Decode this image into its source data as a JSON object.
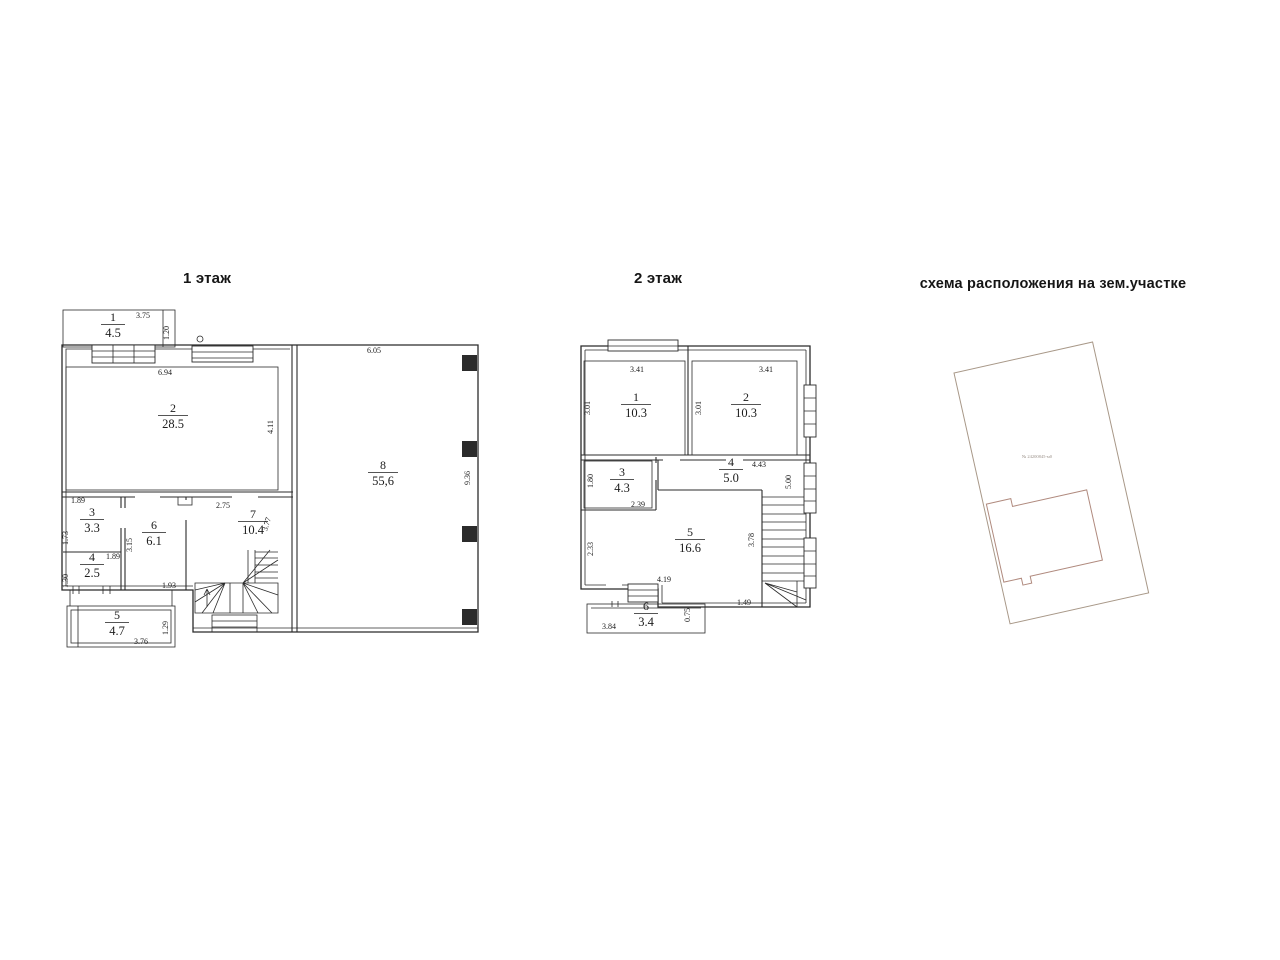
{
  "titles": {
    "floor1": "1 этаж",
    "floor2": "2 этаж",
    "site": "схема расположения на зем.участке"
  },
  "floor1": {
    "rooms": [
      {
        "n": "1",
        "a": "4.5",
        "x": 113,
        "y": 321
      },
      {
        "n": "2",
        "a": "28.5",
        "x": 173,
        "y": 412
      },
      {
        "n": "3",
        "a": "3.3",
        "x": 92,
        "y": 516
      },
      {
        "n": "4",
        "a": "2.5",
        "x": 92,
        "y": 561
      },
      {
        "n": "5",
        "a": "4.7",
        "x": 117,
        "y": 619
      },
      {
        "n": "6",
        "a": "6.1",
        "x": 154,
        "y": 529
      },
      {
        "n": "7",
        "a": "10.4",
        "x": 253,
        "y": 518
      },
      {
        "n": "8",
        "a": "55,6",
        "x": 383,
        "y": 469
      }
    ],
    "dims": [
      {
        "t": "3.75",
        "x": 143,
        "y": 318,
        "r": 0
      },
      {
        "t": "1.20",
        "x": 169,
        "y": 333,
        "r": -90
      },
      {
        "t": "6.94",
        "x": 165,
        "y": 375,
        "r": 0
      },
      {
        "t": "4.11",
        "x": 273,
        "y": 427,
        "r": -90
      },
      {
        "t": "1.89",
        "x": 78,
        "y": 503,
        "r": 0
      },
      {
        "t": "1.73",
        "x": 68,
        "y": 538,
        "r": -90
      },
      {
        "t": "1.89",
        "x": 113,
        "y": 559,
        "r": 0
      },
      {
        "t": "1.30",
        "x": 68,
        "y": 581,
        "r": -90
      },
      {
        "t": "3.15",
        "x": 132,
        "y": 545,
        "r": -90
      },
      {
        "t": "1.93",
        "x": 169,
        "y": 588,
        "r": 0
      },
      {
        "t": "2.75",
        "x": 223,
        "y": 508,
        "r": 0
      },
      {
        "t": "3.77",
        "x": 269,
        "y": 525,
        "r": -72
      },
      {
        "t": "6.05",
        "x": 374,
        "y": 353,
        "r": 0
      },
      {
        "t": "9.36",
        "x": 470,
        "y": 478,
        "r": -90
      },
      {
        "t": "3.76",
        "x": 141,
        "y": 644,
        "r": 0
      },
      {
        "t": "1.29",
        "x": 168,
        "y": 628,
        "r": -90
      }
    ]
  },
  "floor2": {
    "rooms": [
      {
        "n": "1",
        "a": "10.3",
        "x": 636,
        "y": 401
      },
      {
        "n": "2",
        "a": "10.3",
        "x": 746,
        "y": 401
      },
      {
        "n": "3",
        "a": "4.3",
        "x": 622,
        "y": 476
      },
      {
        "n": "4",
        "a": "5.0",
        "x": 731,
        "y": 466
      },
      {
        "n": "5",
        "a": "16.6",
        "x": 690,
        "y": 536
      },
      {
        "n": "6",
        "a": "3.4",
        "x": 646,
        "y": 610
      }
    ],
    "dims": [
      {
        "t": "3.41",
        "x": 637,
        "y": 372,
        "r": 0
      },
      {
        "t": "3.01",
        "x": 590,
        "y": 408,
        "r": -90
      },
      {
        "t": "3.41",
        "x": 766,
        "y": 372,
        "r": 0
      },
      {
        "t": "3.01",
        "x": 701,
        "y": 408,
        "r": -90
      },
      {
        "t": "1.80",
        "x": 593,
        "y": 481,
        "r": -90
      },
      {
        "t": "2.39",
        "x": 638,
        "y": 507,
        "r": 0
      },
      {
        "t": "4.43",
        "x": 759,
        "y": 467,
        "r": 0
      },
      {
        "t": "5.00",
        "x": 791,
        "y": 482,
        "r": -90
      },
      {
        "t": "2.33",
        "x": 593,
        "y": 549,
        "r": -90
      },
      {
        "t": "3.78",
        "x": 754,
        "y": 540,
        "r": -90
      },
      {
        "t": "4.19",
        "x": 664,
        "y": 582,
        "r": 0
      },
      {
        "t": "1.49",
        "x": 744,
        "y": 605,
        "r": 0
      },
      {
        "t": "3.84",
        "x": 609,
        "y": 629,
        "r": 0
      },
      {
        "t": "0.75",
        "x": 690,
        "y": 615,
        "r": -90
      }
    ]
  },
  "site": {
    "plot_label": "№ 24200845-м0"
  },
  "colors": {
    "line": "#2b2b2b",
    "ink": "#1c1c1c",
    "plot_outline": "#a89888",
    "footprint_outline": "#b08a7e"
  }
}
